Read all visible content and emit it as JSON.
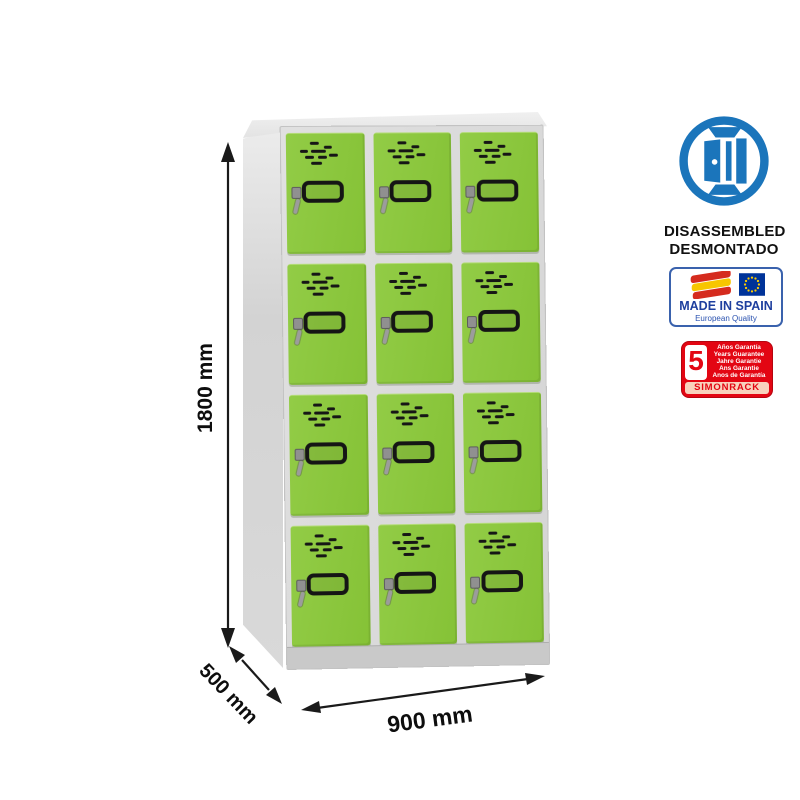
{
  "product": {
    "type": "metal locker cabinet, 12 compartments",
    "columns": 3,
    "rows": 4,
    "door_color": "#8CC63F",
    "frame_color": "#DCDCDC"
  },
  "dimensions": {
    "height_label": "1800 mm",
    "depth_label": "500 mm",
    "width_label": "900 mm"
  },
  "badges": {
    "disassembled": {
      "icon": "open-door-icon",
      "accent_color": "#1B75BB",
      "line1": "DISASSEMBLED",
      "line2": "DESMONTADO"
    },
    "made_in_spain": {
      "flag_icons": [
        "spain-flag-icon",
        "eu-flag-icon"
      ],
      "title": "MADE IN SPAIN",
      "subtitle": "European Quality",
      "text_color": "#1E3F9E",
      "eu_flag_color": "#003399",
      "star_color": "#FFCC00"
    },
    "guarantee": {
      "accent_color": "#E30613",
      "years": "5",
      "lines": [
        "Años Garantía",
        "Years Guarantee",
        "Jahre Garantie",
        "Ans Garantie",
        "Anos de Garantía"
      ],
      "brand": "SIMONRACK"
    }
  }
}
